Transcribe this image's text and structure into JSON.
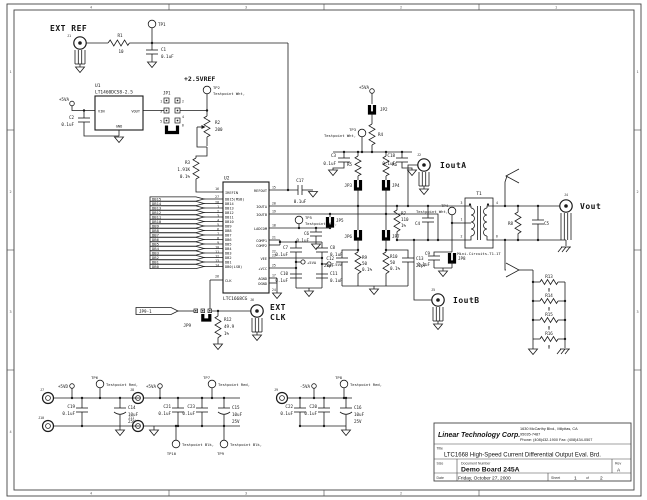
{
  "frame": {
    "zones_h": [
      "4",
      "3",
      "2",
      "1"
    ],
    "zones_v": [
      "1",
      "2",
      "3",
      "4"
    ]
  },
  "title_block": {
    "company": "Linear Technology Corp.",
    "addr1": "1630 McCarthy Blvd., Milpitas, CA",
    "addr2": "95035-7487",
    "addr3": "Phone: (408)432-1900 Fax: (408)434-0507",
    "title_label": "Title",
    "title": "LTC1668 High-Speed Current Differential Output Eval. Brd.",
    "size_label": "Size",
    "doc_label": "Document Number",
    "doc": "Demo Board 245A",
    "rev_label": "Rev",
    "rev": "A",
    "date_label": "Date",
    "date": "Friday, October 27, 2000",
    "sheet_label": "Sheet",
    "sheet_no": "1",
    "of_label": "of",
    "sheet_total": "2"
  },
  "extref": {
    "title": "EXT REF",
    "j1": "J1",
    "tp1": "TP1",
    "r1": "R1",
    "r1v": "10",
    "c1": "C1",
    "c1v": "0.1uF"
  },
  "reg": {
    "p5va": "+5VA",
    "u1": "U1",
    "part": "LT1460DCS8-2.5",
    "vin": "VIN",
    "vout": "VOUT",
    "gnd": "GND",
    "c2": "C2",
    "c2v": "0.1uF",
    "jp1": "JP1",
    "p1": "1",
    "p2": "2",
    "p3": "3",
    "p4": "4",
    "p5": "5",
    "p6": "6"
  },
  "vref": {
    "label": "+2.5VREF",
    "tp2": "TP2",
    "tp2t": "Testpoint Wht,",
    "r2": "R2",
    "r2v": "200",
    "r3": "R3",
    "r3v": "1.91K",
    "r3t": "0.1%"
  },
  "dac": {
    "ref": "U2",
    "part": "LTC1668CG",
    "c17": "C17",
    "c17v": "0.1uF",
    "lpins": [
      {
        "n": "16",
        "name": "IREFIN"
      },
      {
        "n": "27",
        "name": "DB15(MSB)"
      },
      {
        "n": "28",
        "name": "DB14"
      },
      {
        "n": "1",
        "name": "DB13"
      },
      {
        "n": "2",
        "name": "DB12"
      },
      {
        "n": "3",
        "name": "DB11"
      },
      {
        "n": "4",
        "name": "DB10"
      },
      {
        "n": "5",
        "name": "DB9"
      },
      {
        "n": "6",
        "name": "DB8"
      },
      {
        "n": "7",
        "name": "DB7"
      },
      {
        "n": "8",
        "name": "DB6"
      },
      {
        "n": "9",
        "name": "DB5"
      },
      {
        "n": "10",
        "name": "DB4"
      },
      {
        "n": "11",
        "name": "DB3"
      },
      {
        "n": "12",
        "name": "DB2"
      },
      {
        "n": "13",
        "name": "DB1"
      },
      {
        "n": "14",
        "name": "DB0(LSB)"
      },
      {
        "n": "26",
        "name": "CLK"
      }
    ],
    "rpins": [
      {
        "n": "15",
        "name": "REFOUT"
      },
      {
        "n": "20",
        "name": "IOUTA"
      },
      {
        "n": "19",
        "name": "IOUTB"
      },
      {
        "n": "18",
        "name": "LADCOM"
      },
      {
        "n": "21",
        "name": "COMP1"
      },
      {
        "n": "22",
        "name": "COMP2"
      },
      {
        "n": "23",
        "name": "VEE"
      },
      {
        "n": "25",
        "name": "+VCC"
      },
      {
        "n": "17",
        "name": "AGND"
      },
      {
        "n": "24",
        "name": "DGND"
      }
    ],
    "flags": [
      "DB15",
      "DB14",
      "DB13",
      "DB12",
      "DB11",
      "DB10",
      "DB9",
      "DB8",
      "DB7",
      "DB6",
      "DB5",
      "DB4",
      "DB3",
      "DB2",
      "DB1",
      "DB0"
    ]
  },
  "bias": {
    "p5va": "+5VA",
    "jp2": "JP2",
    "r4": "R4",
    "tp3": "TP3",
    "tp3t": "Testpoint Wht,",
    "c3": "C3",
    "c3v": "0.1uF",
    "c18": "C18",
    "c18v": "0.1uF",
    "r5": "R5",
    "r6": "R6",
    "jp3": "JP3",
    "jp4": "JP4"
  },
  "out": {
    "jp5": "JP5",
    "jp6": "JP6",
    "jp7": "JP7",
    "r9": "R9",
    "r9v": "50",
    "r9t": "0.1%",
    "r10": "R10",
    "r10v": "50",
    "r10t": "0.1%",
    "c12": "C12",
    "c12v": "22pF",
    "c13": "C13",
    "c13v": "22pF",
    "r7": "R7",
    "r7v": "110",
    "r7t": "1%",
    "c4": "C4",
    "tp4": "TP4",
    "tp4t": "Testpoint Wht,",
    "c9": "C9",
    "c9v": "0.1uF",
    "jp8": "JP8",
    "j2": "J2",
    "j2l": "IoutA",
    "j5": "J5",
    "j5l": "IoutB",
    "tp5": "TP5",
    "tp5t": "Testpoint Wht,",
    "c6": "C6",
    "c6v": "0.1uF",
    "c7": "C7",
    "c7v": "0.1uF",
    "c8": "C8",
    "c8v": "0.1uF",
    "c10": "C10",
    "c10v": "0.1uF",
    "c11": "C11",
    "c11v": "0.1uF",
    "p5va": "+5VA",
    "m5va": "-5VA"
  },
  "t1": {
    "ref": "T1",
    "part": "Mini-Circuits-T1-1T",
    "p3": "3",
    "p1": "1",
    "p2": "2",
    "p4": "4",
    "p6": "6"
  },
  "vo": {
    "j4": "J4",
    "label": "Vout",
    "r8": "R8",
    "c5": "C5"
  },
  "clk": {
    "flag": "JP9-1",
    "jp9": "JP9",
    "r12": "R12",
    "r12v": "49.9",
    "r12t": "1%",
    "j6": "J6",
    "l1": "EXT",
    "l2": "CLK"
  },
  "term": {
    "items": [
      {
        "r": "R13",
        "v": "0"
      },
      {
        "r": "R14",
        "v": "0"
      },
      {
        "r": "R15",
        "v": "0"
      },
      {
        "r": "R16",
        "v": "0"
      }
    ]
  },
  "pwr": {
    "g1": {
      "j_top": "J7",
      "j_bot": "J10",
      "rail": "+5VD",
      "tp": "TP6",
      "tpt": "Testpoint Red,",
      "c_a": "C19",
      "c_a_v": "0.1uF",
      "c_b": "C14",
      "c_b_v": "10uF",
      "c_b_r": "25V"
    },
    "g2": {
      "j_top": "J8",
      "j_bot": "J11",
      "rail": "+5VA",
      "tp": "TP7",
      "tpt": "Testpoint Red,",
      "c_a": "C21",
      "c_a_v": "0.1uF",
      "c_b": "C23",
      "c_b_v": "0.1uF",
      "c_c": "C15",
      "c_c_v": "10uF",
      "c_c_r": "25V",
      "tp_b1": "TP10",
      "tp_b1t": "Testpoint Blk,",
      "tp_b2": "TP9",
      "tp_b2t": "Testpoint Blk,"
    },
    "g3": {
      "j": "J9",
      "rail": "-5VA",
      "tp": "TP8",
      "tpt": "Testpoint Red,",
      "c_a": "C22",
      "c_a_v": "0.1uF",
      "c_b": "C20",
      "c_b_v": "0.1uF",
      "c_c": "C16",
      "c_c_v": "10uF",
      "c_c_r": "25V"
    }
  }
}
